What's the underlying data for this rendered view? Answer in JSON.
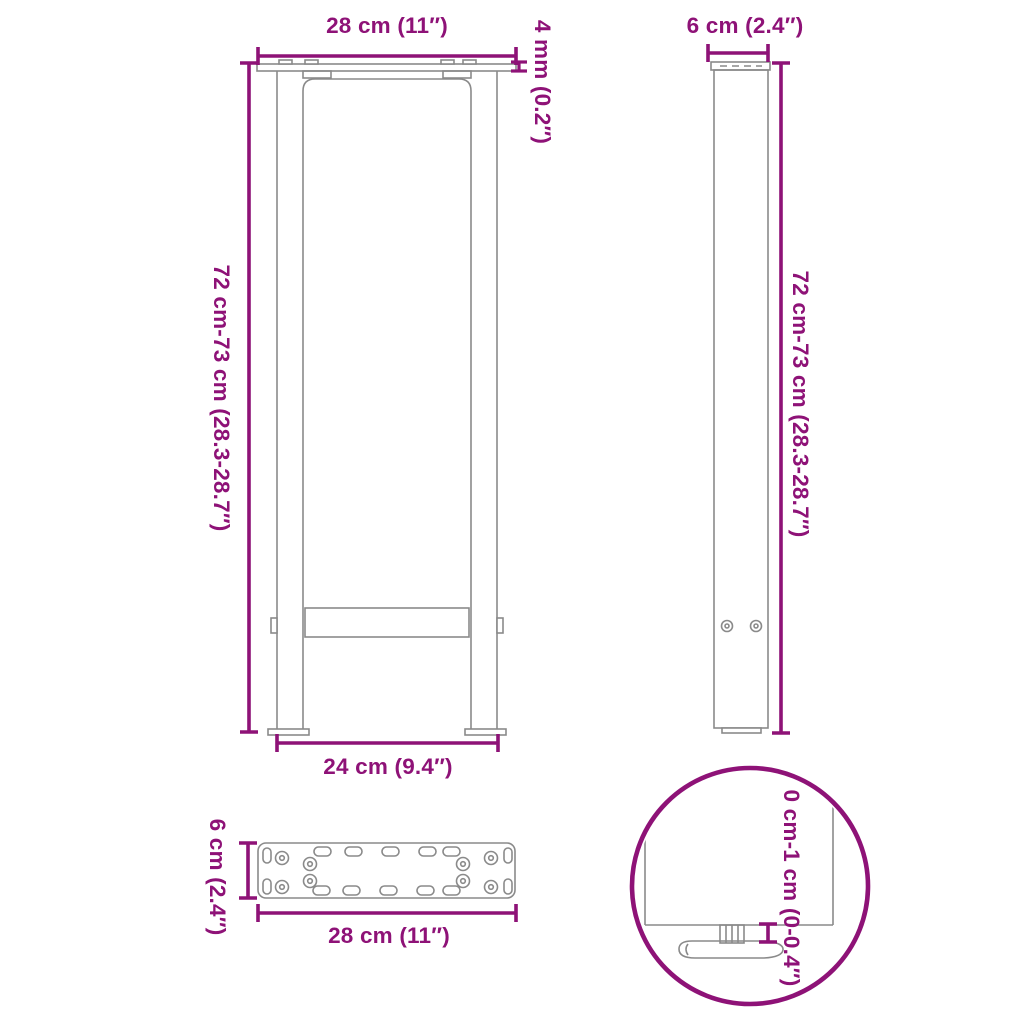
{
  "colors": {
    "dimension": "#8E1277",
    "drawing_line": "#8a8a8a",
    "background": "#ffffff"
  },
  "diagram_type": "furniture-leg-dimension-drawing",
  "front_view": {
    "width_top_label": "28 cm (11″)",
    "plate_thickness_label": "4 mm (0.2″)",
    "height_label": "72 cm-73 cm (28.3-28.7″)",
    "width_bottom_label": "24 cm (9.4″)"
  },
  "side_view": {
    "depth_label": "6 cm (2.4″)",
    "height_label": "72 cm-73 cm (28.3-28.7″)"
  },
  "plate_top_view": {
    "depth_label": "6 cm (2.4″)",
    "width_label": "28 cm (11″)"
  },
  "foot_detail_view": {
    "adjustable_height_label": "0 cm-1 cm (0-0.4″)"
  }
}
